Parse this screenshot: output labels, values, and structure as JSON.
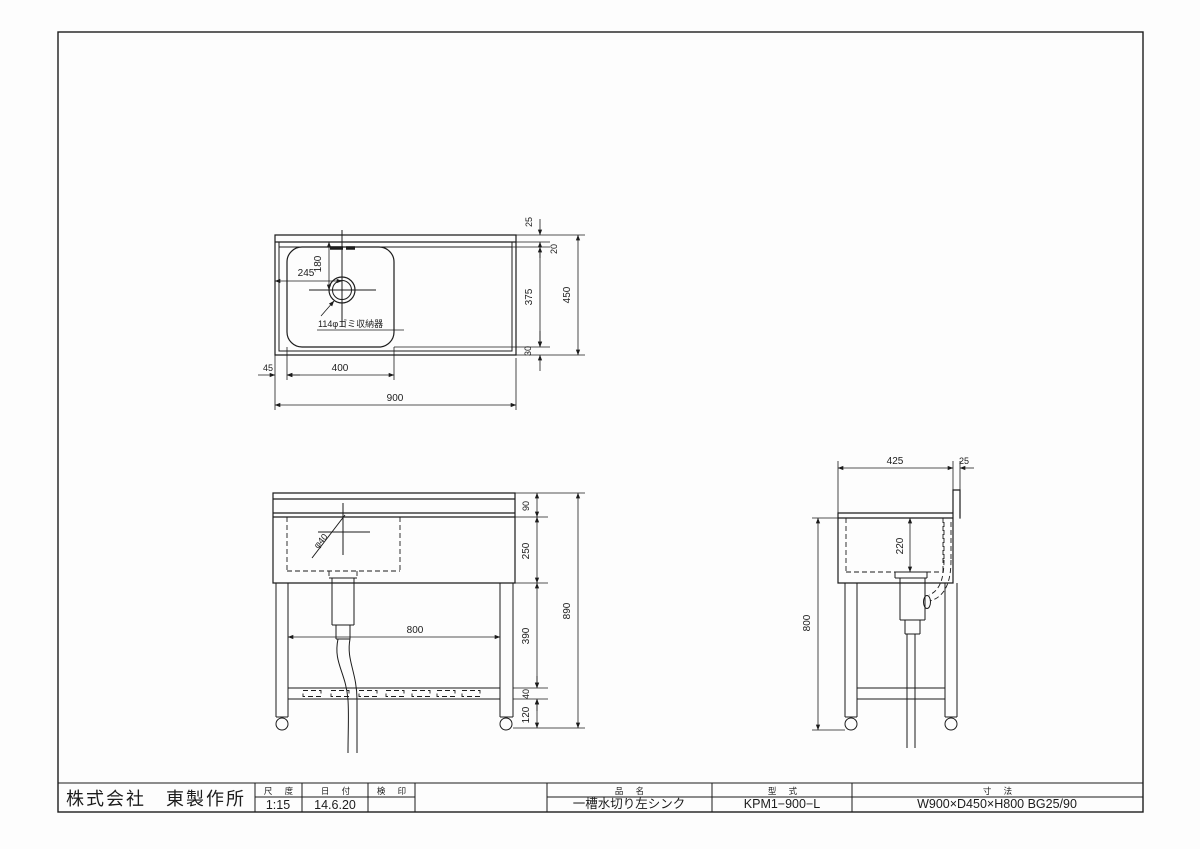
{
  "title_block": {
    "company": "株式会社　東製作所",
    "scale_label": "尺 度",
    "scale_value": "1:15",
    "date_label": "日 付",
    "date_value": "14.6.20",
    "stamp_label": "検 印",
    "product_label": "品 名",
    "product_value": "一槽水切り左シンク",
    "model_label": "型 式",
    "model_value": "KPM1−900−L",
    "size_label": "寸 法",
    "size_value": "W900×D450×H800 BG25/90"
  },
  "plan_view": {
    "drain_note": "114φゴミ収納器",
    "dims": {
      "bg_width": "25",
      "back_gap": "20",
      "bowl_depth": "375",
      "front_gap": "30",
      "total_depth": "450",
      "drain_offset_x": "245",
      "drain_offset_y": "180",
      "left_gap": "45",
      "bowl_width": "400",
      "total_width": "900"
    }
  },
  "front_view": {
    "dims": {
      "backsplash_height": "90",
      "bowl_height": "250",
      "leg_upper": "390",
      "shelf_frame": "40",
      "caster_height": "120",
      "total_height": "890",
      "leg_span": "800",
      "faucet_hole": "φ40"
    }
  },
  "side_view": {
    "dims": {
      "top_depth": "425",
      "backsplash_thickness": "25",
      "bowl_inner_depth": "220",
      "body_height": "800"
    }
  }
}
